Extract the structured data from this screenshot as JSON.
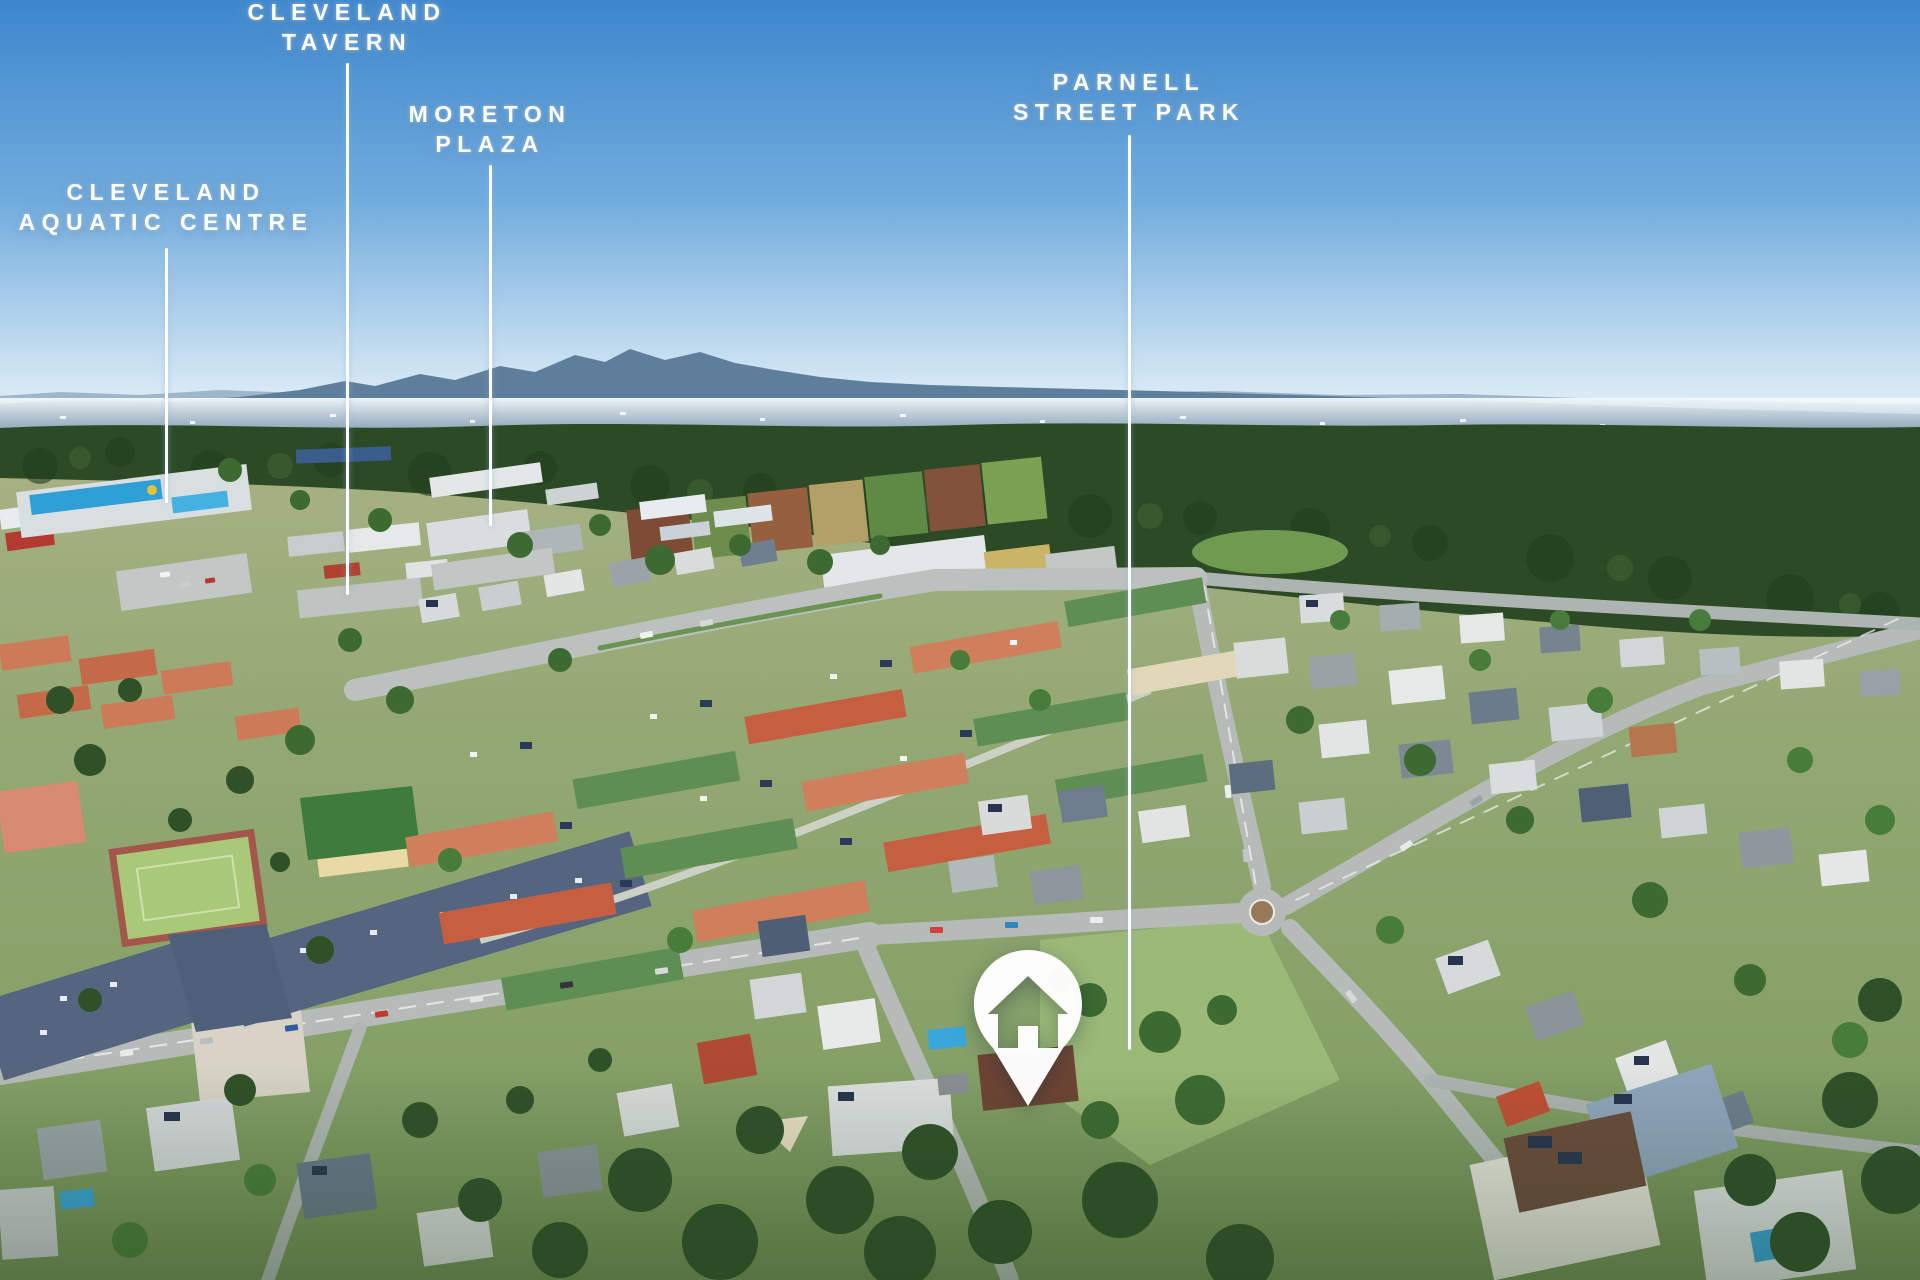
{
  "scene": {
    "type": "real-estate-aerial-photo",
    "description": "Aerial drone photograph of a coastal suburb with labelled points of interest and a property location pin"
  },
  "callouts": [
    {
      "id": "cleveland-tavern",
      "lines": [
        "CLEVELAND",
        "TAVERN"
      ]
    },
    {
      "id": "moreton-plaza",
      "lines": [
        "MORETON",
        "PLAZA"
      ]
    },
    {
      "id": "cleveland-aquatic-centre",
      "lines": [
        "CLEVELAND",
        "AQUATIC CENTRE"
      ]
    },
    {
      "id": "parnell-street-park",
      "lines": [
        "PARNELL",
        "STREET PARK"
      ]
    }
  ],
  "marker": {
    "name": "subject-property-pin",
    "icon": "house-icon"
  },
  "colors": {
    "label_text": "#ffffff",
    "callout_line": "#ffffff",
    "pin_fill": "#ffffff",
    "sky_top": "#3d87cd",
    "sky_horizon": "#eef5fa"
  }
}
